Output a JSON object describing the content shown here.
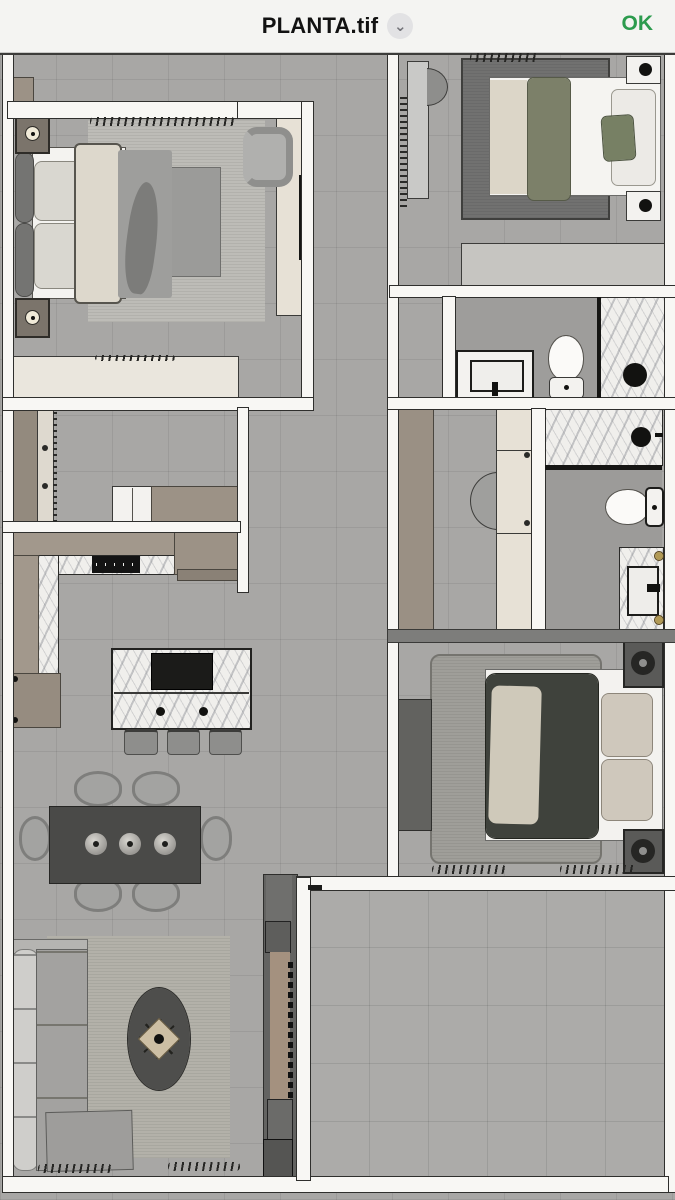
{
  "header": {
    "title": "PLANTA.tif",
    "chevron_glyph": "⌄",
    "ok_label": "OK"
  },
  "colors": {
    "accent": "#2c9b4e",
    "floor": "#a8a7a5",
    "wall": "#f8f7f4",
    "wood": "#9c9286",
    "cream": "#e7e1d6",
    "marble": "#f0efec",
    "charcoal_table": "#4a4a48",
    "olive_textile": "#7c8069",
    "dark_bed_blanket": "#3f423c",
    "rug_dark": "#717170",
    "rug_light": "#bdbcb7",
    "fixture_black": "#121210",
    "brass": "#b29a55"
  }
}
